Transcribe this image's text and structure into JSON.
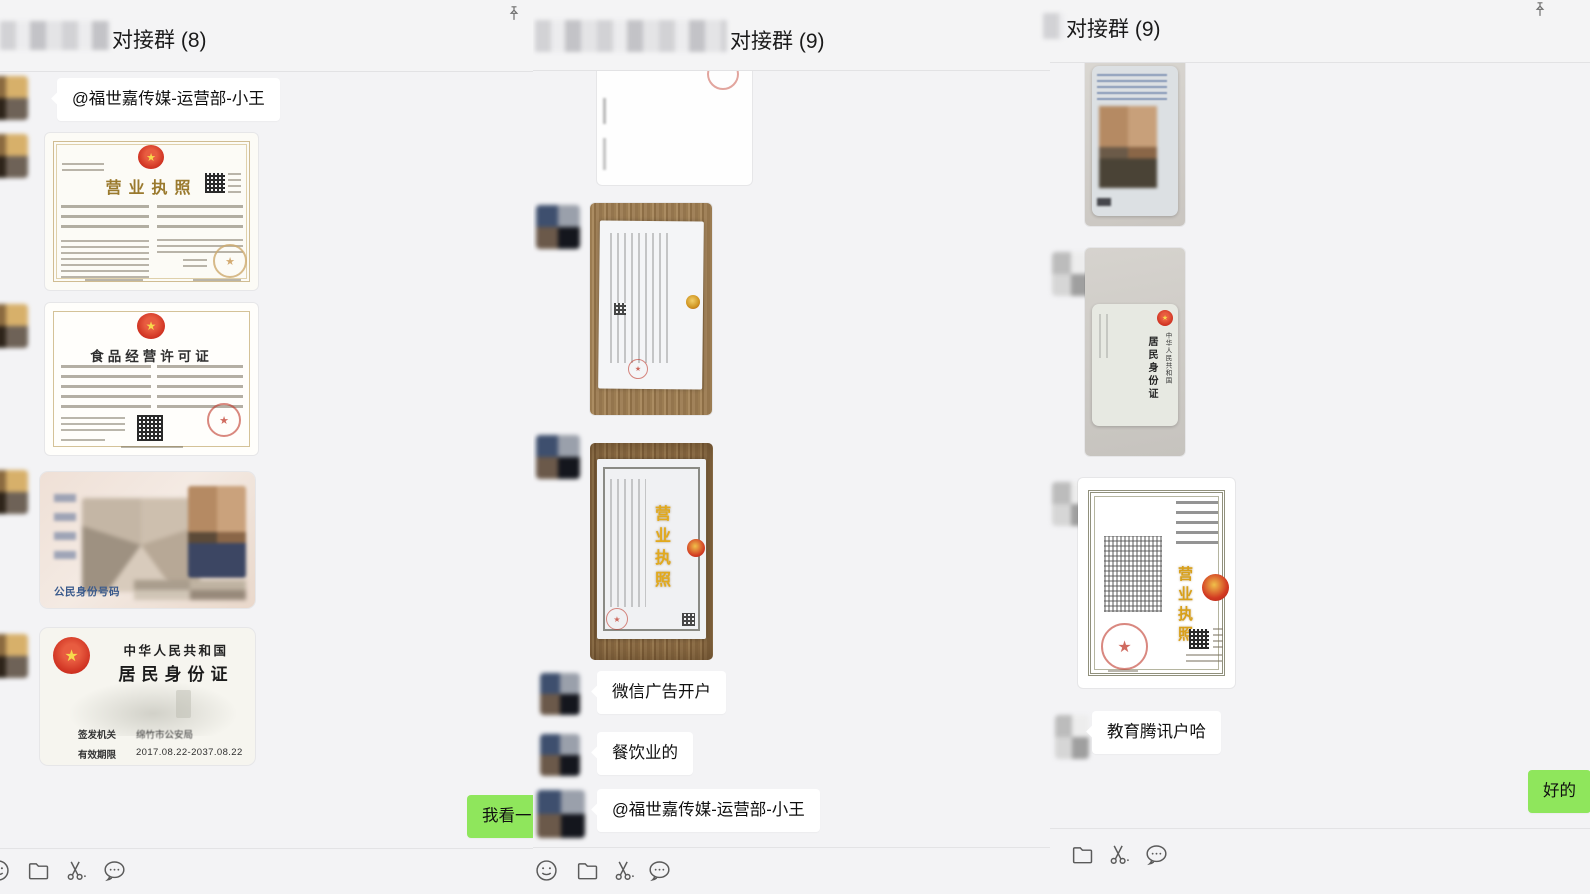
{
  "app": "wechat-desktop-chats",
  "colors": {
    "background": "#f3f3f5",
    "bubble_received": "#ffffff",
    "bubble_sent_green": "#8fe65c",
    "seal_red": "#c0392b",
    "license_gold": "#a8873f",
    "icon_gray": "#5a5a5a"
  },
  "lp": {
    "title": "对接群 (8)",
    "mention": "@福世嘉传媒-运营部-小王",
    "sent": "我看一",
    "license": {
      "title": "营业执照"
    },
    "food": {
      "title": "食品经营许可证"
    },
    "id_front": {
      "label": "公民身份号码"
    },
    "id_back": {
      "country": "中华人民共和国",
      "card": "居民身份证",
      "issuer_label": "签发机关",
      "issuer": "绵竹市公安局",
      "validity_label": "有效期限",
      "validity": "2017.08.22-2037.08.22"
    }
  },
  "mp": {
    "title": "对接群 (9)",
    "messages": [
      "微信广告开户",
      "餐饮业的",
      "@福世嘉传媒-运营部-小王"
    ],
    "license_title": "营业执照"
  },
  "rp": {
    "title": "对接群 (9)",
    "received": "教育腾讯户哈",
    "sent": "好的",
    "id_back": {
      "country": "中华人民共和国",
      "card": "居民身份证"
    },
    "license_title": "营业执照"
  },
  "icons": {
    "pin": "pin-icon",
    "emoji": "emoji-icon",
    "folder": "folder-icon",
    "screenshot": "scissors-screenshot-icon",
    "history": "chat-bubble-icon"
  }
}
